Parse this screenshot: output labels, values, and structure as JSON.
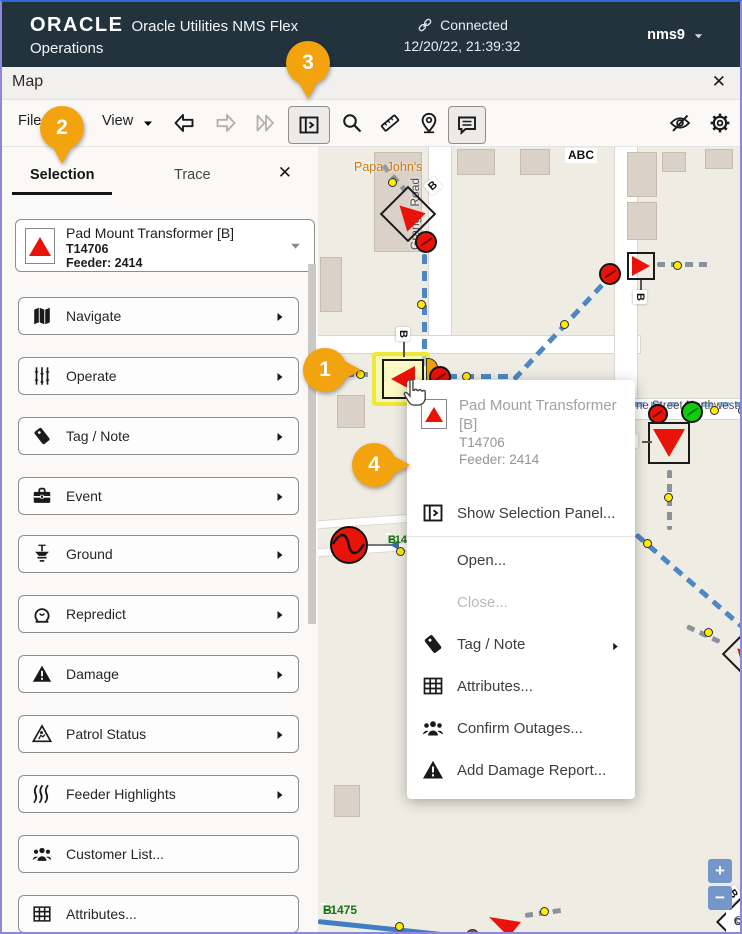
{
  "header": {
    "brand": "ORACLE",
    "title_line1": "Oracle Utilities NMS Flex",
    "title_line2": "Operations",
    "connection_status": "Connected",
    "timestamp": "12/20/22, 21:39:32",
    "user_menu": "nms9"
  },
  "window": {
    "title": "Map",
    "close_glyph": "✕"
  },
  "toolbar": {
    "file_menu": "File",
    "view_menu": "View"
  },
  "panel_tabs": {
    "selection": "Selection",
    "trace": "Trace",
    "close_glyph": "✕"
  },
  "device_selector": {
    "title": "Pad Mount Transformer [B]",
    "device_id": "T14706",
    "feeder": "Feeder: 2414"
  },
  "sidebar_buttons": [
    {
      "label": "Navigate",
      "icon": "map-icon",
      "chevron": true
    },
    {
      "label": "Operate",
      "icon": "sliders-icon",
      "chevron": true
    },
    {
      "label": "Tag / Note",
      "icon": "tag-icon",
      "chevron": true
    },
    {
      "label": "Event",
      "icon": "briefcase-icon",
      "chevron": true
    },
    {
      "label": "Ground",
      "icon": "ground-icon",
      "chevron": true
    },
    {
      "label": "Repredict",
      "icon": "repredict-icon",
      "chevron": true
    },
    {
      "label": "Damage",
      "icon": "warning-icon",
      "chevron": true
    },
    {
      "label": "Patrol Status",
      "icon": "patrol-icon",
      "chevron": true
    },
    {
      "label": "Feeder Highlights",
      "icon": "waves-icon",
      "chevron": true
    },
    {
      "label": "Customer List...",
      "icon": "people-icon",
      "chevron": false
    },
    {
      "label": "Attributes...",
      "icon": "grid-icon",
      "chevron": false
    }
  ],
  "context_menu": {
    "title": "Pad Mount Transformer [B]",
    "device_id": "T14706",
    "feeder": "Feeder: 2414",
    "items": [
      {
        "label": "Show Selection Panel..."
      },
      {
        "label": "Open..."
      },
      {
        "label": "Close..."
      },
      {
        "label": "Tag / Note"
      },
      {
        "label": "Attributes..."
      },
      {
        "label": "Confirm Outages..."
      },
      {
        "label": "Add Damage Report..."
      }
    ]
  },
  "callouts": {
    "c1": "1",
    "c2": "2",
    "c3": "3",
    "c4": "4"
  },
  "map": {
    "poi_label": "Papa John's",
    "abc_label": "ABC",
    "road_label_vertical": "Grange Road",
    "street_label": "ne Street Northwest",
    "b_label": "B",
    "feeder_tag_1": {
      "line1": "F14",
      "line2": "B"
    },
    "feeder_tag_2": {
      "line1": "F1475",
      "line2": "B"
    },
    "zoom_in": "+",
    "zoom_out": "−",
    "attribution": {
      "copyright": "© ",
      "link": "OpenStreetMap",
      "suffix": " contributors."
    }
  },
  "colors": {
    "accent_orange": "#F2A30E",
    "feeder_blue": "#4E87C5",
    "device_red": "#E91309",
    "header_bg": "#22333D",
    "highlight_yellow": "#EEE73C"
  }
}
